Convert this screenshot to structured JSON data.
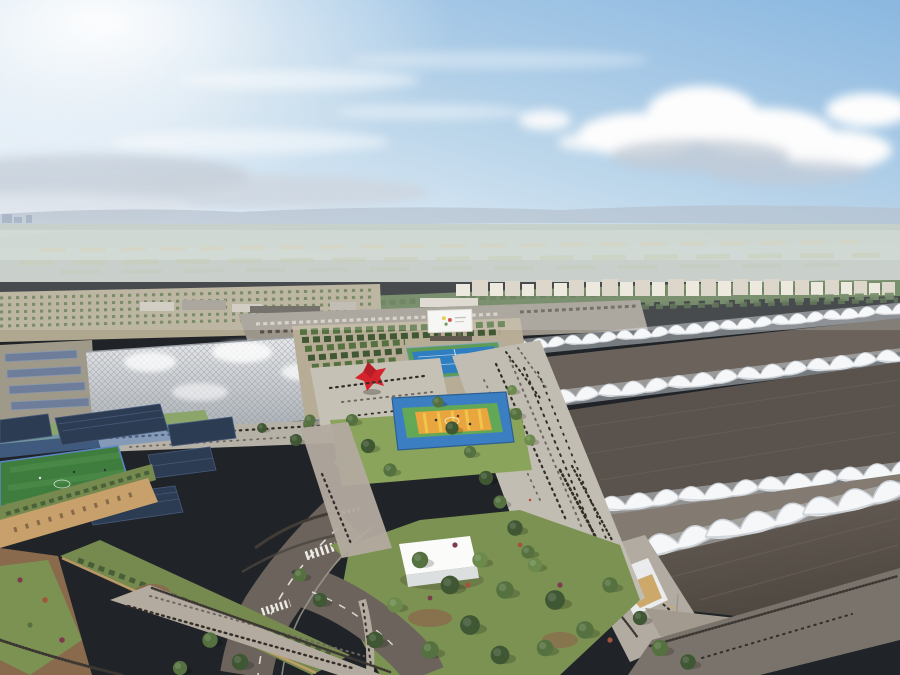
{
  "meta": {
    "title": "Aerial architectural rendering — expo campus with exhibition halls, park and sports facilities",
    "image_kind": "photorealistic masterplan visualization, bird's-eye view, daytime"
  },
  "scene": {
    "description": "Sunlit aerial view: hazy plain and mountains on the horizon, a belt of forest and distant white apartment blocks, a crystalline glass-lattice pavilion on the left, a central park with a red sculpture, tennis and basketball courts, crowded pedestrian promenades, and a row of huge exhibition halls with dark roofs and white scalloped tensile canopies on the right; roads, a white pavilion, a soccer field, rooftop solar arrays and green-roof buildings fill the foreground.",
    "elements": [
      {
        "name": "sky",
        "note": "blue sky, bright sun glare upper-left, cumulus clouds upper-right"
      },
      {
        "name": "mountains",
        "note": "hazy blue ridge line across the horizon"
      },
      {
        "name": "farmland-plain",
        "note": "pale green and tan fields below the mountains"
      },
      {
        "name": "forest-belt",
        "note": "dense dark-green tree band mid-distance"
      },
      {
        "name": "residential-towers",
        "note": "row of white/beige apartment blocks behind the halls"
      },
      {
        "name": "orchard-rows",
        "note": "plantation rows on the left mid-ground"
      },
      {
        "name": "parking-lot",
        "note": "car park with rows of cars and solar carports"
      },
      {
        "name": "billboard",
        "note": "white billboard with small colorful logo, center"
      },
      {
        "name": "glass-lattice-pavilion",
        "note": "large translucent grid-shell building, left"
      },
      {
        "name": "red-sculpture",
        "note": "angular bright red artwork in tree-lined plaza"
      },
      {
        "name": "tennis-courts",
        "note": "blue courts with green surround"
      },
      {
        "name": "basketball-court",
        "note": "blue/green/orange-yellow court in the park"
      },
      {
        "name": "central-park",
        "note": "lawns, dense trees, paths, scattered visitors"
      },
      {
        "name": "promenade",
        "note": "wide walkway full of tiny pedestrians leading to hall entrances"
      },
      {
        "name": "exhibition-halls",
        "note": "parallel halls, dark flat roofs, white scalloped tensile canopy bands"
      },
      {
        "name": "hall-entrance-terrace",
        "note": "membrane canopy over terrace with tables and amber glass facade"
      },
      {
        "name": "access-roads",
        "note": "curving asphalt roads with white markings and a zebra crossing"
      },
      {
        "name": "white-pavilion",
        "note": "small flat-roofed white box among garden trees"
      },
      {
        "name": "soccer-field",
        "note": "green pitch with blue fencing, lower-left"
      },
      {
        "name": "solar-arrays",
        "note": "dark-blue photovoltaic panels on roofs"
      },
      {
        "name": "green-roof-buildings",
        "note": "beige-walled buildings with planted roofs and ramps"
      },
      {
        "name": "fences",
        "note": "dark vertical-slat fences along roads and gardens"
      },
      {
        "name": "crowds",
        "note": "hundreds of tiny pedestrians across plazas and walkways"
      }
    ]
  },
  "colors": {
    "sky_blue": "#8ab7e0",
    "sky_pale": "#eef5fb",
    "sun_glow": "#ffffff",
    "cloud_white": "#fdfdfd",
    "cloud_grey": "#c2cbd6",
    "mountain_far": "#b6c2cf",
    "mountain_near": "#9fadbf",
    "valley": "#c6d0c9",
    "field_tan": "#cdc9ad",
    "forest": "#5d7850",
    "forest_dark": "#47603b",
    "city_face": "#eae4d8",
    "city_shade": "#d6cfc0",
    "ind_roof": "#57534c",
    "orchard_ground": "#afa78f",
    "orchard_tree": "#5d7447",
    "parking": "#9b958a",
    "car_light": "#cfcabf",
    "car_dark": "#56514b",
    "solar_canopy": "#6e7d99",
    "lattice_top": "#e9eaec",
    "lattice_bot": "#aab0b6",
    "lattice_line": "#878d94",
    "billboard_white": "#f4f4f2",
    "sculpture_red": "#d5232d",
    "plaza": "#c6c1b5",
    "bosque_ground": "#b7ad97",
    "tennis_blue": "#2f7ec0",
    "tennis_green": "#5f9b58",
    "court_blue": "#3b7fc2",
    "court_green": "#63a857",
    "court_orange": "#e9a53e",
    "court_yellow": "#f2c94e",
    "lawn": "#7c9252",
    "lawn_light": "#8aa45c",
    "tree_dark": "#3f5733",
    "tree_mid": "#54713f",
    "tree_light": "#6b8a4c",
    "shrub_plum": "#7d3b4f",
    "shrub_rust": "#a2543e",
    "promenade": "#c2bdb2",
    "walkway": "#b3ab9f",
    "road": "#6b635c",
    "road_dark": "#5c554e",
    "marking": "#eceae4",
    "curb": "#a39d92",
    "fence_dark": "#3c3733",
    "canopy_white": "#f6f7f8",
    "canopy_shade": "#ccd2d8",
    "hall_far": "#6a625b",
    "hall_mid": "#5a524c",
    "hall_near": "#4a433d",
    "alley": "#837b72",
    "facade": "#e9ebed",
    "facade_line": "#c3c7cb",
    "glass_amber": "#c79c52",
    "glass_dark": "#332f2b",
    "terrace": "#b2aba2",
    "pavilion": "#fbfbfa",
    "pavilion_side": "#dcdfe0",
    "pitch": "#3f7d3f",
    "pitch_light": "#4f8d4a",
    "fence_blue": "#5b86c4",
    "solar_dark": "#2c3c52",
    "solar_line": "#47597a",
    "earth": "#8a6a4c",
    "tan_wall": "#c8a06b",
    "green_roof": "#76894f",
    "crowd": "#332d28",
    "crowd_light": "#6e675f",
    "accent_yellow": "#e6c532",
    "accent_red": "#c23b2f"
  }
}
